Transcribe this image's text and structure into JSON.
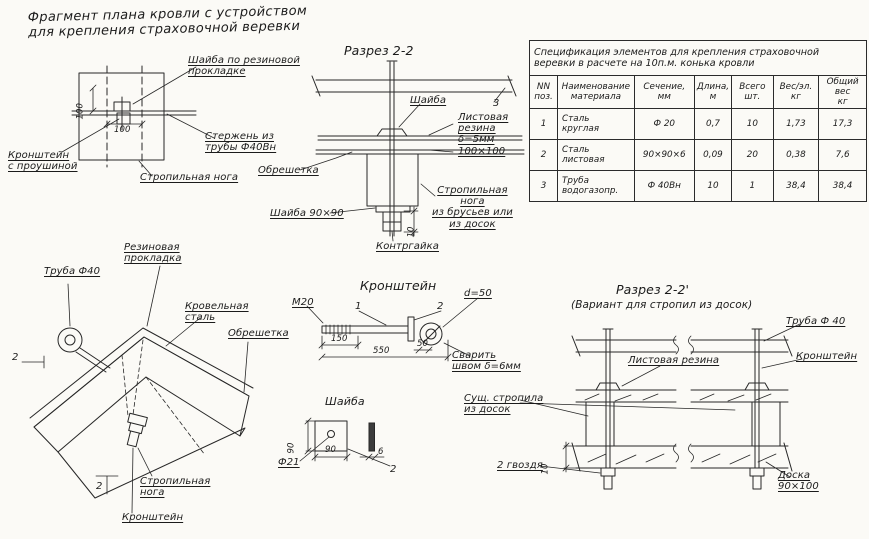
{
  "page_title": "Фрагмент плана кровли с устройством\nдля крепления страховочной веревки",
  "plan_view": {
    "washer_label": "Шайба по резиновой\nпрокладке",
    "dim_vertical": "100",
    "dim_horizontal": "100",
    "rod_label": "Стержень из\nтрубы Ф40Вн",
    "bracket_label": "Кронштейн\nс проушиной",
    "rafter_label": "Стропильная нога"
  },
  "section_2_2": {
    "title": "Разрез 2-2",
    "washer_label": "Шайба",
    "part_number": "3",
    "rubber_label": "Листовая\nрезина\nδ=5мм\n100×100",
    "sheathing_label": "Обрешетка",
    "rafter_label": "Стропильная\nнога\nиз брусьев или\nиз досок",
    "washer_90_label": "Шайба 90×90",
    "locknut_label": "Контргайка",
    "dim_nut": "10"
  },
  "spec_table": {
    "title": "Спецификация элементов для крепления страховочной\nверевки в расчете на 10п.м. конька кровли",
    "headers": [
      "NN\nпоз.",
      "Наименование\nматериала",
      "Сечение,\nмм",
      "Длина,\nм",
      "Всего\nшт.",
      "Вес/эл.\nкг",
      "Общий вес\nкг"
    ],
    "rows": [
      [
        "1",
        "Сталь\nкруглая",
        "Ф 20",
        "0,7",
        "10",
        "1,73",
        "17,3"
      ],
      [
        "2",
        "Сталь\nлистовая",
        "90×90×6",
        "0,09",
        "20",
        "0,38",
        "7,6"
      ],
      [
        "3",
        "Труба\nводогазопр.",
        "Ф 40Вн",
        "10",
        "1",
        "38,4",
        "38,4"
      ]
    ]
  },
  "ridge_view": {
    "rubber_label": "Резиновая\nпрокладка",
    "pipe_label": "Труба Ф40",
    "steel_label": "Кровельная\nсталь",
    "sheathing_label": "Обрешетка",
    "rafter_label": "Стропильная\nнога",
    "bracket_label": "Кронштейн",
    "section_mark": "2"
  },
  "bracket_detail": {
    "title": "Кронштейн",
    "thread_label": "М20",
    "part_1": "1",
    "part_2": "2",
    "eye_dia_label": "d=50",
    "dim_thread": "150",
    "dim_total": "550",
    "dim_eye": "50",
    "weld_label": "Сварить\nшвом δ=6мм"
  },
  "washer_detail": {
    "title": "Шайба",
    "dim_side_v": "90",
    "dim_side_h": "90",
    "hole_label": "Ф21",
    "dim_thickness": "6",
    "part_2": "2"
  },
  "section_2_2v": {
    "title": "Разрез 2-2'",
    "subtitle": "(Вариант для стропил из досок)",
    "pipe_label": "Труба Ф 40",
    "rubber_label": "Листовая резина",
    "bracket_label": "Кронштейн",
    "rafter_label": "Сущ. стропила\nиз досок",
    "nails_label": "2 гвоздя",
    "board_label": "Доска\n90×100",
    "dim_board": "10"
  }
}
